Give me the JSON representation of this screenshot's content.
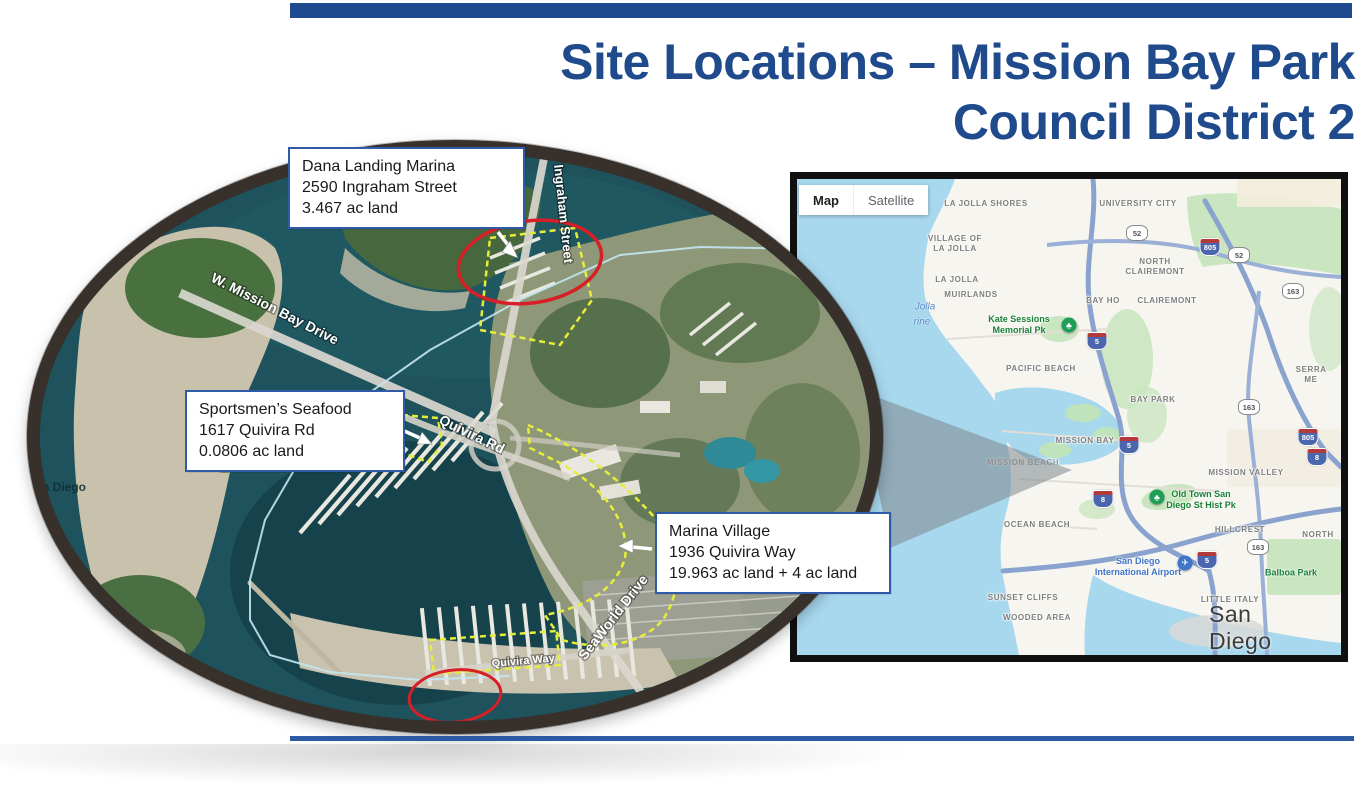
{
  "page": {
    "title_line1": "Site Locations – Mission Bay Park",
    "title_line2": "Council District 2"
  },
  "callouts": [
    {
      "title": "Dana Landing Marina",
      "address": "2590 Ingraham Street",
      "area": "3.467 ac land"
    },
    {
      "title": "Sportsmen’s Seafood",
      "address": "1617 Quivira Rd",
      "area": "0.0806 ac land"
    },
    {
      "title": "Marina Village",
      "address": "1936 Quivira Way",
      "area": "19.963 ac land + 4 ac land"
    }
  ],
  "aerial": {
    "roads": [
      "W. Mission Bay Drive",
      "Ingraham Street",
      "Quivira Rd",
      "Quivira Way",
      "SeaWorld Drive"
    ],
    "watermark": "n Diego"
  },
  "map": {
    "controls": {
      "map": "Map",
      "satellite": "Satellite"
    },
    "neighborhoods": [
      "LA JOLLA SHORES",
      "UNIVERSITY CITY",
      "VILLAGE OF LA JOLLA",
      "NORTH CLAIREMONT",
      "LA JOLLA",
      "MUIRLANDS",
      "BAY HO",
      "CLAIREMONT",
      "PACIFIC BEACH",
      "SERRA ME",
      "BAY PARK",
      "MISSION BAY",
      "MISSION BEACH",
      "MISSION VALLEY",
      "OCEAN BEACH",
      "HILLCREST",
      "NORTH",
      "SUNSET CLIFFS",
      "LITTLE ITALY",
      "WOODED AREA"
    ],
    "parks": [
      "Kate Sessions Memorial Pk",
      "Old Town San Diego St Hist Pk",
      "Balboa Park"
    ],
    "airport": "San Diego International Airport",
    "city": "San Diego",
    "shields": [
      "52",
      "805",
      "52",
      "163",
      "5",
      "163",
      "5",
      "805",
      "8",
      "8",
      "163",
      "5"
    ],
    "water_fragments": [
      "Jolla",
      "rine"
    ]
  }
}
